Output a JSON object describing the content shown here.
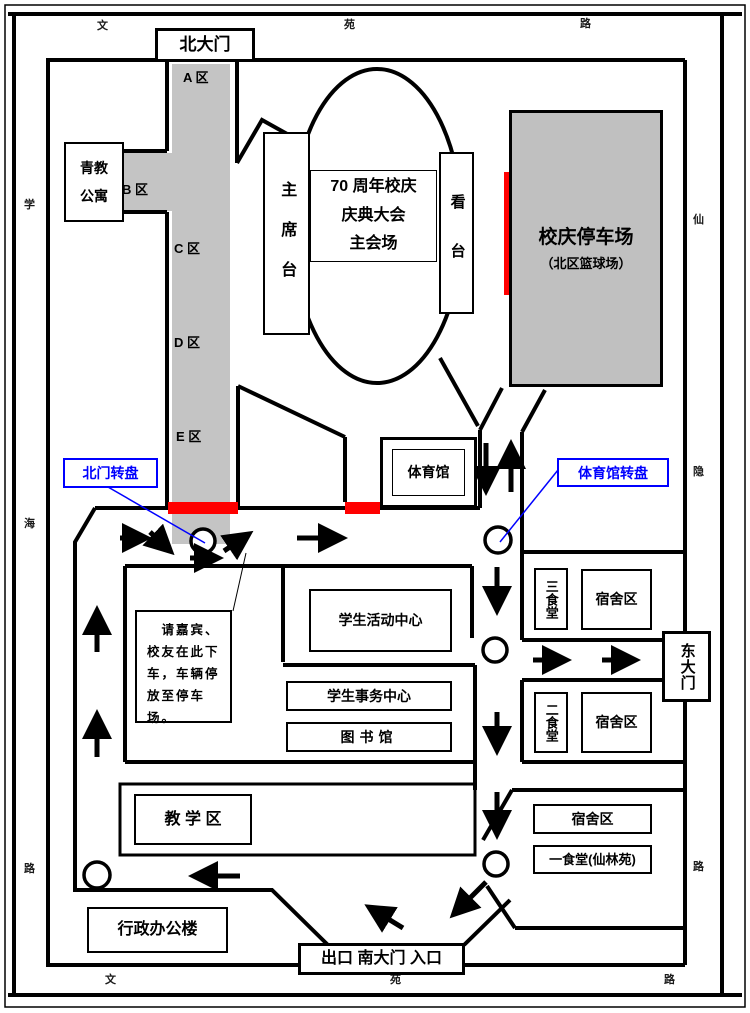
{
  "streets": {
    "top": [
      "文",
      "苑",
      "路"
    ],
    "bottom": [
      "文",
      "苑",
      "路"
    ],
    "left": [
      "学",
      "海",
      "路"
    ],
    "right": [
      "仙",
      "隐",
      "路"
    ]
  },
  "gates": {
    "north": "北大门",
    "east": "东大门",
    "south": "出口 南大门 入口"
  },
  "zones": [
    "A 区",
    "B 区",
    "C 区",
    "D 区",
    "E 区"
  ],
  "venue": {
    "stage": "主席台",
    "main": "70 周年校庆\n庆典大会\n主会场",
    "stand": "看台"
  },
  "parking": {
    "title": "校庆停车场",
    "subtitle": "（北区篮球场）"
  },
  "buildings": {
    "qingjiao_apartment": "青教\n公寓",
    "gymnasium": "体育馆",
    "student_activity_center": "学生活动中心",
    "student_affairs_center": "学生事务中心",
    "library": "图书馆",
    "canteen_3": "三食堂",
    "dorm_area_1": "宿舍区",
    "canteen_2": "二食堂",
    "dorm_area_2": "宿舍区",
    "dorm_area_3": "宿舍区",
    "canteen_1": "一食堂(仙林苑)",
    "teaching_area": "教 学 区",
    "admin_building": "行政办公楼"
  },
  "callouts": {
    "north_roundabout": "北门转盘",
    "gym_roundabout": "体育馆转盘"
  },
  "note": {
    "text": "　请嘉宾、\n校友在此下\n车，车辆停\n放至停车\n场。"
  },
  "colors": {
    "road_gray": "#c4c4c4",
    "stop_red": "#ff0000",
    "callout_blue": "#0000ff"
  }
}
